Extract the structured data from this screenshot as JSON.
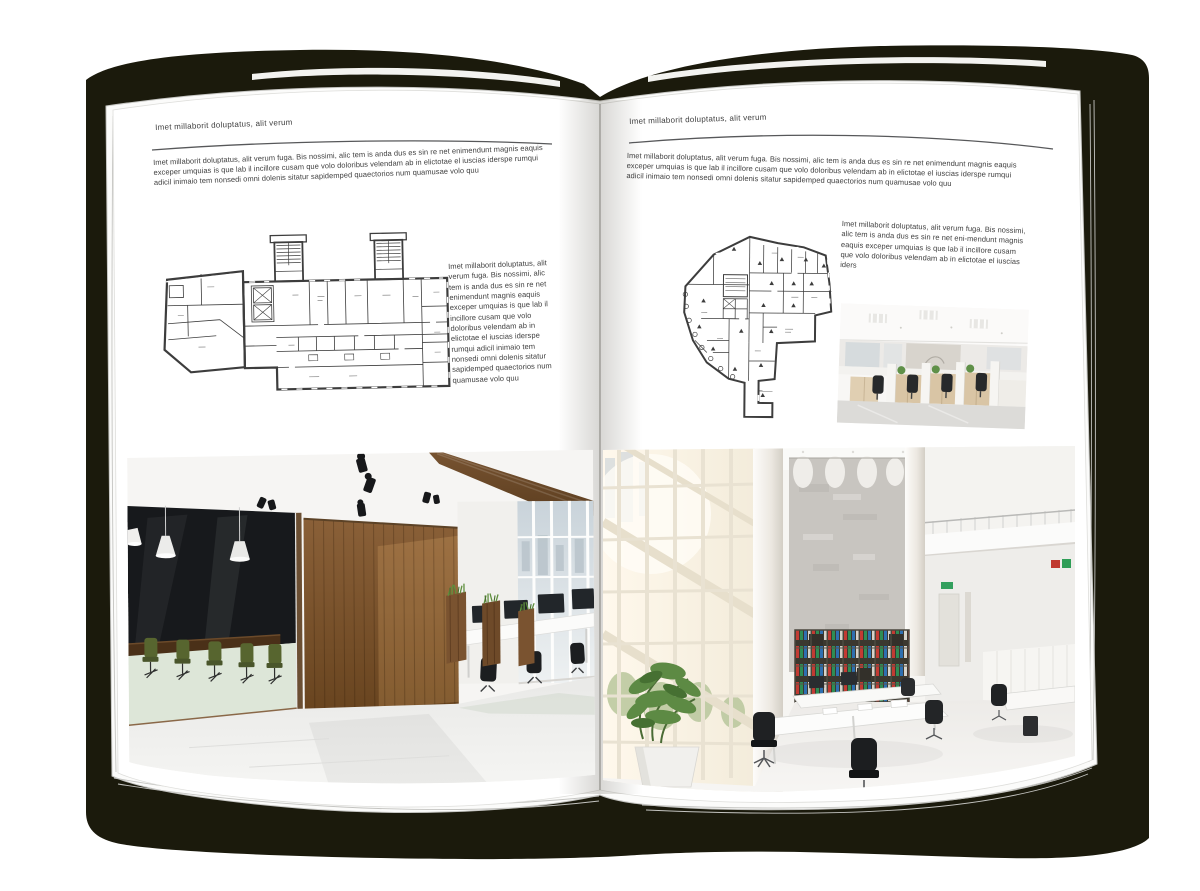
{
  "left_page": {
    "header": "Imet millaborit doluptatus, alit verum",
    "intro": "Imet millaborit doluptatus, alit verum fuga. Bis nossimi, alic tem is anda dus es sin re net enimendunt magnis eaquis exceper umquias is que lab il incillore cusam que volo doloribus velendam ab in elictotae el iuscias iderspe rumqui adicil inimaio tem nonsedi omni dolenis sitatur sapidemped quaectorios num quamusae volo quu",
    "sidebar_text": "Imet millaborit doluptatus, alit verum fuga. Bis nossimi, alic tem is anda dus es sin re net enimendunt magnis eaquis exceper umquias is que lab il incillore cusam que volo doloribus velendam ab in elictotae el iuscias iderspe rumqui adicil inimaio tem nonsedi omni dolenis sitatur sapidemped quaectorios num quamusae volo quu"
  },
  "right_page": {
    "header": "Imet millaborit doluptatus, alit verum",
    "intro": "Imet millaborit doluptatus, alit verum fuga. Bis nossimi, alic tem is anda dus es sin re net enimendunt magnis eaquis exceper umquias is que lab il incillore cusam que volo doloribus velendam ab in elictotae el iuscias iderspe rumqui adicil inimaio tem nonsedi omni dolenis sitatur sapidemped quaectorios num quamusae volo quu",
    "sidebar_text": "Imet millaborit doluptatus, alit verum fuga. Bis nossimi, alic tem is anda dus es sin re net eni-mendunt magnis eaquis exceper umquias is que lab il incillore cusam que volo doloribus velendam ab in elictotae el iuscias iders"
  },
  "colors": {
    "cover_shadow": "#1b1a0c",
    "page": "#ffffff",
    "text": "#3e3e3e",
    "header_rule": "#57585a",
    "plan_line": "#3d3d3d",
    "wood_wall": "#7a5433",
    "meeting_glass": "#17191c",
    "chair_green": "#57652f",
    "chair_black": "#1f2123",
    "binder_red": "#c23b33",
    "binder_green": "#2e8d54",
    "binder_blue": "#2e6fb0",
    "exit_sign_green": "#33a05e",
    "plant_green": "#5d8a44"
  }
}
